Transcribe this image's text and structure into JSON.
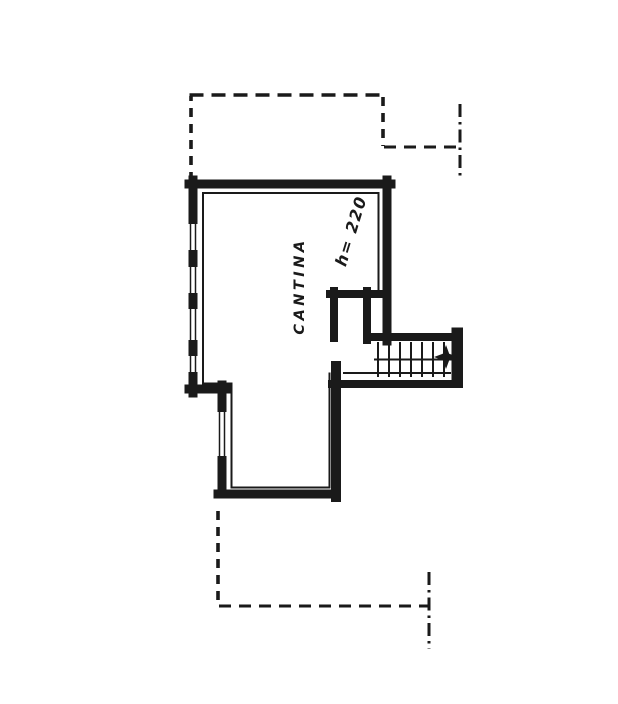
{
  "plan": {
    "room_label": "CANTINA",
    "height_label": "h= 220",
    "colors": {
      "ink": "#1a1a1a",
      "paper": "#ffffff"
    }
  }
}
